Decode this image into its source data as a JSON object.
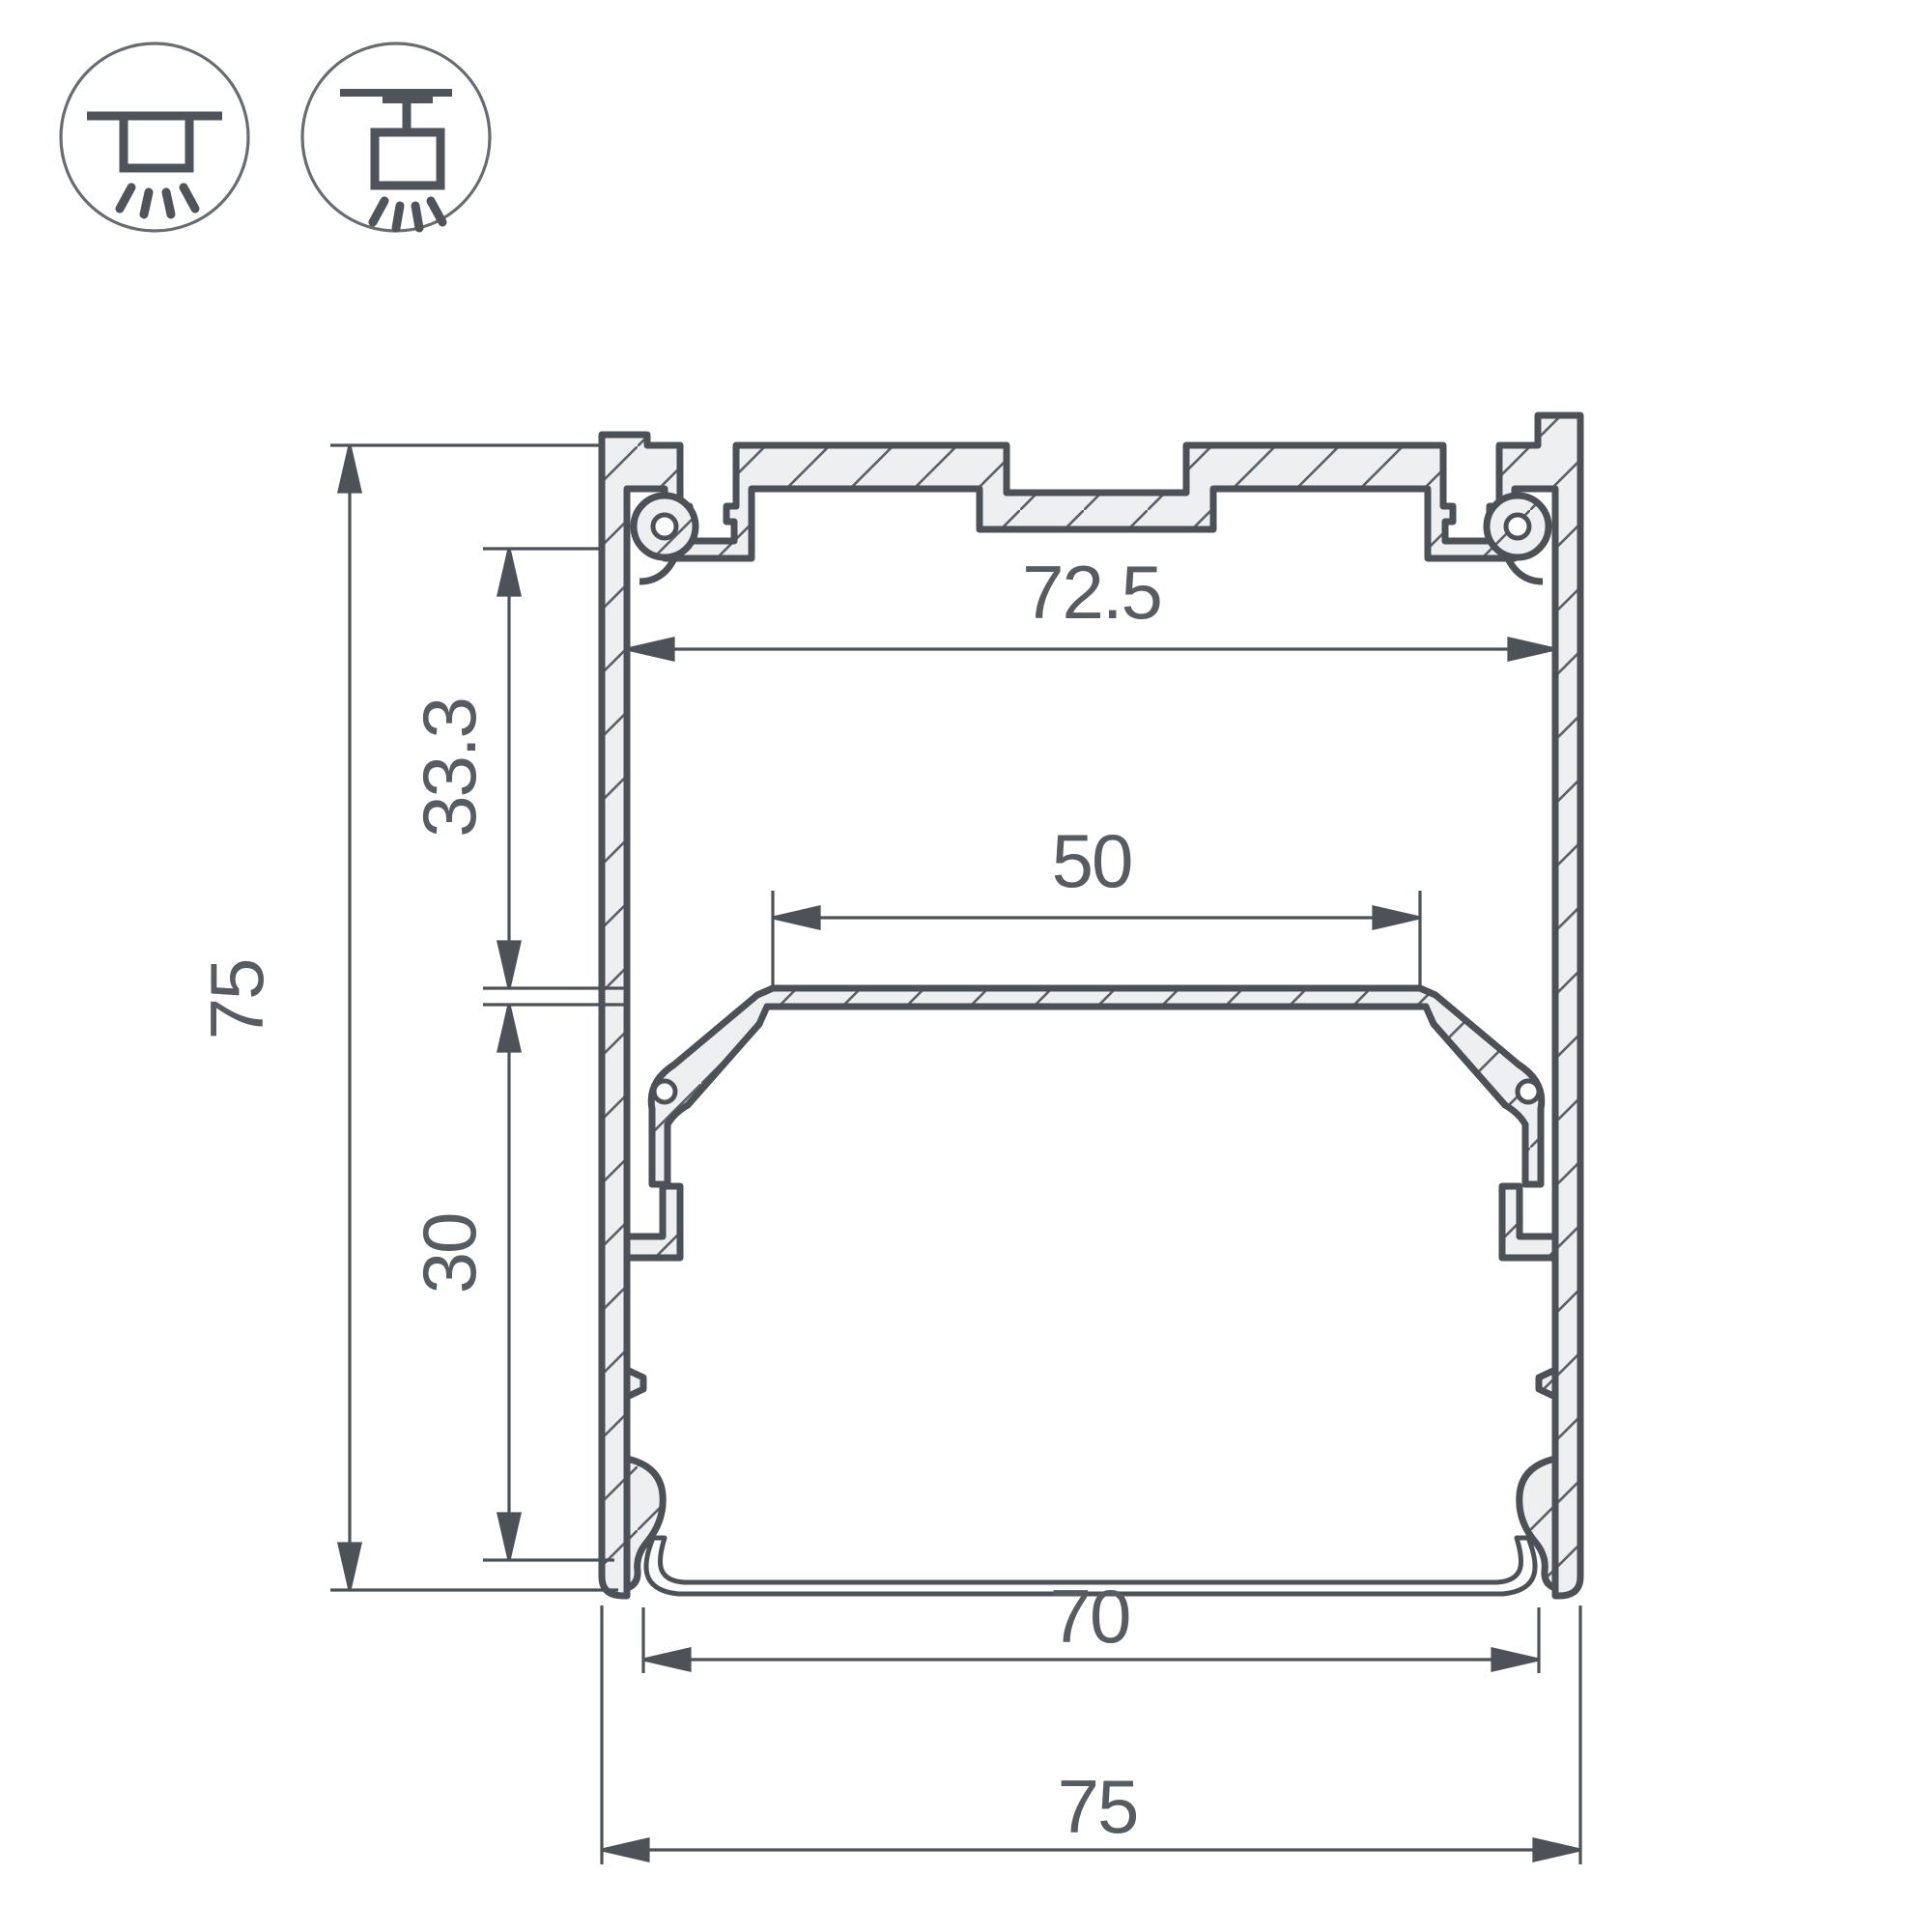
{
  "drawing": {
    "type": "profile-cross-section-technical-drawing",
    "units": "mm"
  },
  "colors": {
    "line": "#4c5258",
    "text": "#565c61",
    "profile_fill": "#edeff1",
    "background": "#ffffff",
    "icon_circle": "#666c71"
  },
  "mount_icons": [
    {
      "name": "surface-mount-icon",
      "meaning": "ceiling surface mounting"
    },
    {
      "name": "pendant-mount-icon",
      "meaning": "suspended / pendant mounting"
    }
  ],
  "dims": {
    "overall_height": "75",
    "upper_cavity_height": "33.3",
    "lower_cavity_height": "30",
    "inner_top_width": "72.5",
    "shelf_width": "50",
    "bottom_width": "70",
    "overall_width": "75"
  }
}
